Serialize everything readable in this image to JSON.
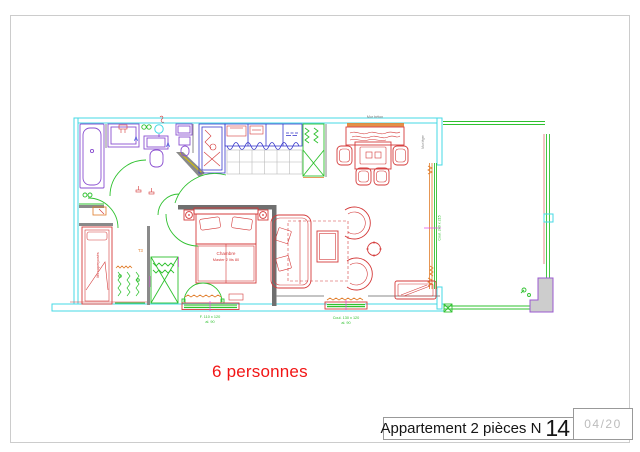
{
  "title_block": {
    "title": "Appartement 2 pièces N",
    "number": "14",
    "sheet": "04/20"
  },
  "capacity": "6 personnes",
  "plan_labels": {
    "wall_top": "Mur béton",
    "wall_right": "Mur léger",
    "room_bedroom_line1": "Chambre",
    "room_bedroom_line2": "Master 2 lits 80",
    "bunk_beds": "lits superposés",
    "type_tag": "T3",
    "bedroom_window_size": "F. 110 x 120",
    "bedroom_window_height": "al. 90",
    "living_window_size": "Coul. 130 x 120",
    "living_window_height": "al. 90",
    "sliding_window_size": "Coul. 240 x 215",
    "section_marker": "A"
  },
  "colors": {
    "outline_cyan": "#45d9e4",
    "furniture_red": "#d43a3a",
    "fixtures_purple": "#8a4fd0",
    "kitchen_blue": "#3a3acc",
    "openings_green": "#2fc12f",
    "accent_orange": "#e07b28",
    "capacity_text": "#f21515",
    "sheet_text": "#bcbcbc"
  }
}
